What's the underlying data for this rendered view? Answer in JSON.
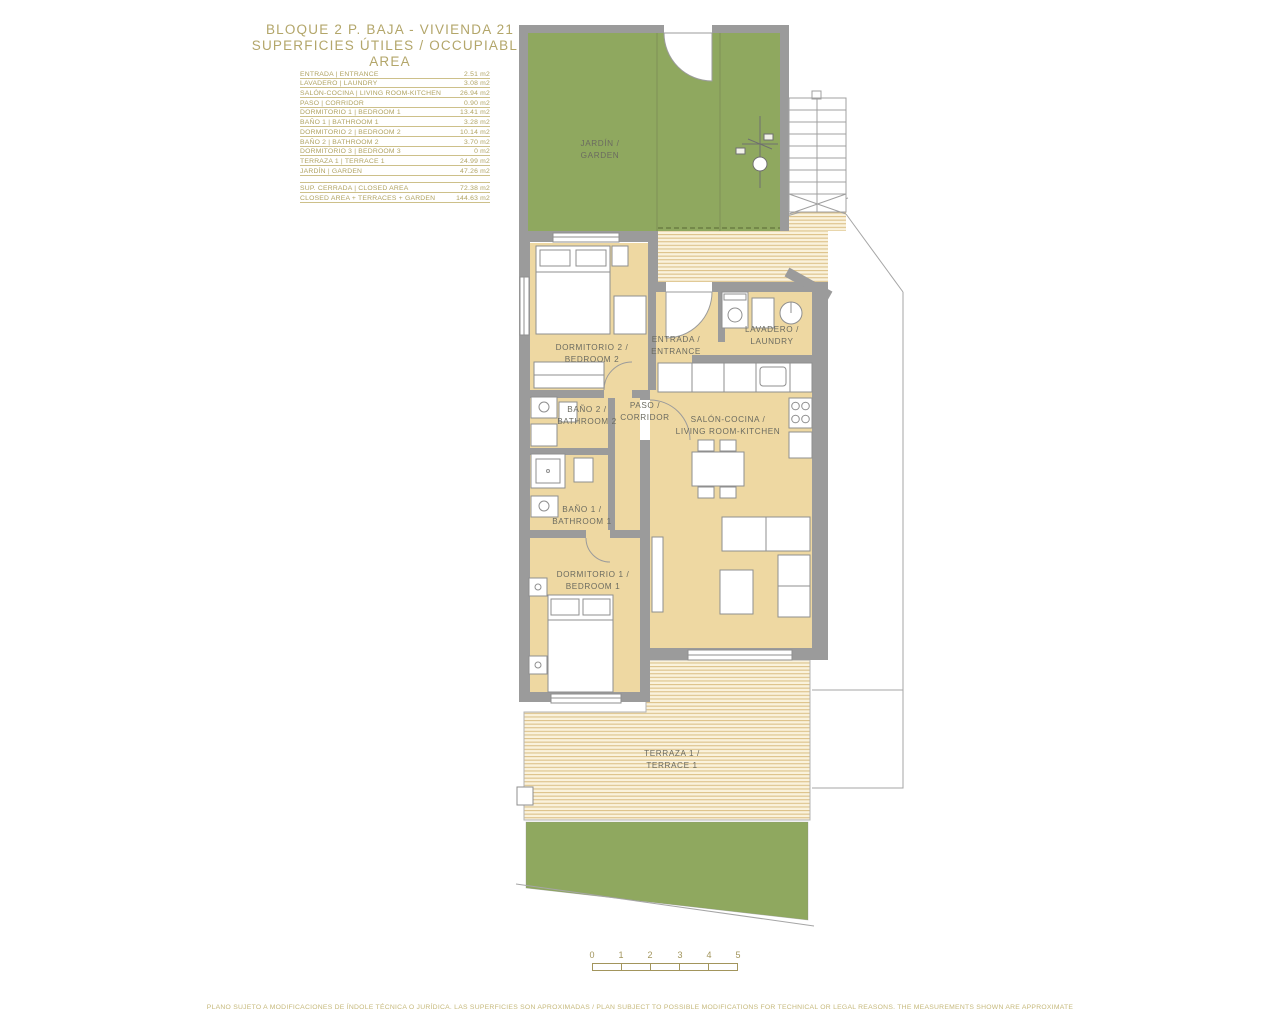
{
  "title": {
    "line1": "BLOQUE 2 P. BAJA - VIVIENDA 21",
    "line2": "SUPERFICIES ÚTILES / OCCUPIABLE AREA"
  },
  "legend": {
    "rows": [
      {
        "label": "ENTRADA | ENTRANCE",
        "value": "2.51 m2"
      },
      {
        "label": "LAVADERO | LAUNDRY",
        "value": "3.08 m2"
      },
      {
        "label": "SALÓN-COCINA | LIVING ROOM-KITCHEN",
        "value": "26.94 m2"
      },
      {
        "label": "PASO | CORRIDOR",
        "value": "0.90 m2"
      },
      {
        "label": "DORMITORIO 1 | BEDROOM 1",
        "value": "13.41 m2"
      },
      {
        "label": "BAÑO 1 | BATHROOM 1",
        "value": "3.28 m2"
      },
      {
        "label": "DORMITORIO 2 | BEDROOM 2",
        "value": "10.14 m2"
      },
      {
        "label": "BAÑO 2 | BATHROOM 2",
        "value": "3.70 m2"
      },
      {
        "label": "DORMITORIO 3 | BEDROOM 3",
        "value": "0 m2"
      },
      {
        "label": "TERRAZA 1 | TERRACE 1",
        "value": "24.99 m2"
      },
      {
        "label": "JARDÍN | GARDEN",
        "value": "47.26 m2"
      }
    ],
    "summary": [
      {
        "label": "SUP. CERRADA | CLOSED AREA",
        "value": "72.38 m2"
      },
      {
        "label": "CLOSED AREA + TERRACES + GARDEN",
        "value": "144.63 m2"
      }
    ]
  },
  "plan": {
    "rooms": {
      "garden": {
        "line1": "JARDÍN /",
        "line2": "GARDEN"
      },
      "bedroom2": {
        "line1": "DORMITORIO 2 /",
        "line2": "BEDROOM 2"
      },
      "entrance": {
        "line1": "ENTRADA /",
        "line2": "ENTRANCE"
      },
      "laundry": {
        "line1": "LAVADERO /",
        "line2": "LAUNDRY"
      },
      "corridor": {
        "line1": "PASO /",
        "line2": "CORRIDOR"
      },
      "bathroom2": {
        "line1": "BAÑO 2 /",
        "line2": "BATHROOM 2"
      },
      "bathroom1": {
        "line1": "BAÑO 1 /",
        "line2": "BATHROOM 1"
      },
      "living": {
        "line1": "SALÓN-COCINA /",
        "line2": "LIVING ROOM-KITCHEN"
      },
      "bedroom1": {
        "line1": "DORMITORIO 1 /",
        "line2": "BEDROOM 1"
      },
      "terrace1": {
        "line1": "TERRAZA 1 /",
        "line2": "TERRACE 1"
      }
    },
    "colors": {
      "garden_green": "#8fa85f",
      "floor_beige": "#eed8a2",
      "wall_gray": "#9b9b9b",
      "stripe_bg": "#faf2dc",
      "stripe_line": "#dcc189",
      "accent_olive": "#b3a66a",
      "label_gray": "#6b6b60"
    }
  },
  "scale_bar": {
    "labels": [
      "0",
      "1",
      "2",
      "3",
      "4",
      "5"
    ]
  },
  "footer": {
    "text": "PLANO SUJETO A MODIFICACIONES DE ÍNDOLE TÉCNICA O JURÍDICA. LAS SUPERFICIES SON APROXIMADAS / PLAN SUBJECT TO POSSIBLE MODIFICATIONS FOR TECHNICAL OR LEGAL REASONS. THE MEASUREMENTS SHOWN ARE APPROXIMATE"
  }
}
